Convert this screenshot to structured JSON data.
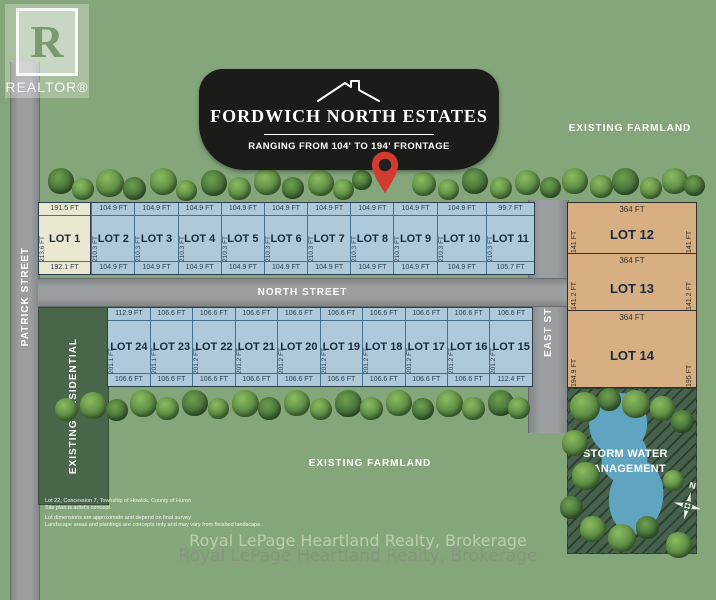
{
  "colors": {
    "background": "#85a67b",
    "banner": "#1b1b19",
    "road": "#9b9ea1",
    "lot_blue": "#adc9da",
    "lot_beige": "#e9e7d0",
    "lot_tan": "#d7af82",
    "dark_green_zone": "#49664b",
    "pond_blue": "#5fa5c2",
    "pin_red": "#d23b2f"
  },
  "logo": {
    "letter": "R",
    "label": "REALTOR®"
  },
  "banner": {
    "title": "FORDWICH NORTH ESTATES",
    "subtitle": "RANGING FROM 104' TO 194' FRONTAGE"
  },
  "streets": {
    "patrick": "PATRICK STREET",
    "north": "NORTH STREET",
    "east": "EAST STREET"
  },
  "labels": {
    "existing_farmland_top": "EXISTING FARMLAND",
    "existing_farmland_bottom": "EXISTING FARMLAND",
    "existing_residential": "EXISTING RESIDENTIAL",
    "storm_water": "STORM WATER MANAGEMENT",
    "compass_n": "N"
  },
  "lots": {
    "top_row": [
      {
        "name": "LOT 1",
        "top": "191.5 FT",
        "bottom": "192.1 FT",
        "side": "213.6 FT",
        "style": "beige"
      },
      {
        "name": "LOT 2",
        "top": "104.9 FT",
        "bottom": "104.9 FT",
        "side": "210.3 FT",
        "style": "blue"
      },
      {
        "name": "LOT 3",
        "top": "104.9 FT",
        "bottom": "104.9 FT",
        "side": "210.3 FT",
        "style": "blue"
      },
      {
        "name": "LOT 4",
        "top": "104.9 FT",
        "bottom": "104.9 FT",
        "side": "210.3 FT",
        "style": "blue"
      },
      {
        "name": "LOT 5",
        "top": "104.9 FT",
        "bottom": "104.9 FT",
        "side": "210.3 FT",
        "style": "blue"
      },
      {
        "name": "LOT 6",
        "top": "104.9 FT",
        "bottom": "104.9 FT",
        "side": "210.3 FT",
        "style": "blue"
      },
      {
        "name": "LOT 7",
        "top": "104.9 FT",
        "bottom": "104.9 FT",
        "side": "210.3 FT",
        "style": "blue"
      },
      {
        "name": "LOT 8",
        "top": "104.9 FT",
        "bottom": "104.9 FT",
        "side": "210.3 FT",
        "style": "blue"
      },
      {
        "name": "LOT 9",
        "top": "104.9 FT",
        "bottom": "104.9 FT",
        "side": "210.3 FT",
        "style": "blue"
      },
      {
        "name": "LOT 10",
        "top": "104.9 FT",
        "bottom": "104.9 FT",
        "side": "210.3 FT",
        "style": "blue"
      },
      {
        "name": "LOT 11",
        "top": "99.7 FT",
        "bottom": "105.7 FT",
        "side": "210.3 FT",
        "style": "blue"
      }
    ],
    "bottom_row": [
      {
        "name": "LOT 24",
        "top": "112.9 FT",
        "bottom": "106.6 FT",
        "side": "201.1 FT"
      },
      {
        "name": "LOT 23",
        "top": "106.6 FT",
        "bottom": "106.6 FT",
        "side": "201.1 FT"
      },
      {
        "name": "LOT 22",
        "top": "106.6 FT",
        "bottom": "106.6 FT",
        "side": "201.2 FT"
      },
      {
        "name": "LOT 21",
        "top": "106.6 FT",
        "bottom": "106.6 FT",
        "side": "201.2 FT"
      },
      {
        "name": "LOT 20",
        "top": "106.6 FT",
        "bottom": "106.6 FT",
        "side": "201.2 FT"
      },
      {
        "name": "LOT 19",
        "top": "106.6 FT",
        "bottom": "106.6 FT",
        "side": "201.2 FT"
      },
      {
        "name": "LOT 18",
        "top": "106.6 FT",
        "bottom": "106.6 FT",
        "side": "201.2 FT"
      },
      {
        "name": "LOT 17",
        "top": "106.6 FT",
        "bottom": "106.6 FT",
        "side": "201.2 FT"
      },
      {
        "name": "LOT 16",
        "top": "106.6 FT",
        "bottom": "106.6 FT",
        "side": "201.2 FT"
      },
      {
        "name": "LOT 15",
        "top": "106.6 FT",
        "bottom": "112.4 FT",
        "side": "201.2 FT"
      }
    ],
    "east_column": [
      {
        "name": "LOT 12",
        "top": "364 FT",
        "left": "141 FT",
        "right": "141 FT"
      },
      {
        "name": "LOT 13",
        "top": "364 FT",
        "left": "141.2 FT",
        "right": "141.2 FT"
      },
      {
        "name": "LOT 14",
        "top": "364 FT",
        "left": "194.9 FT",
        "right": "195 FT"
      }
    ]
  },
  "disclaimer": [
    "Lot 22, Concession 7, Township of Howick, County of Huron",
    "Site plan is artist's concept.",
    "Lot dimensions are approximate and depend on final survey.",
    "Landscape areas and plantings are concepts only and may vary from finished landscape."
  ],
  "footer": {
    "line1": "Royal LePage Heartland Realty, Brokerage",
    "line2": "Royal LePage Heartland Realty, Brokerage"
  }
}
